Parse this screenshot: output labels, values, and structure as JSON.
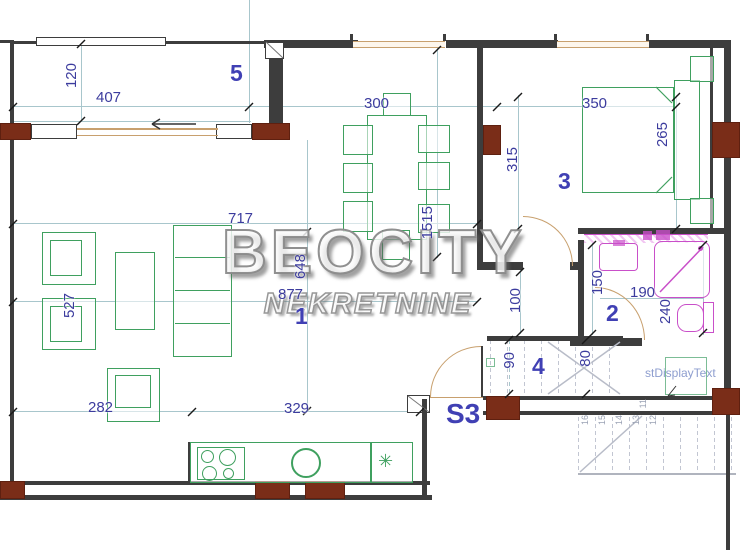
{
  "watermark": {
    "line1": "BEOCITY",
    "line2": "NEKRETNINE"
  },
  "rooms": [
    {
      "id": "5",
      "label": "5",
      "x": 230,
      "y": 62
    },
    {
      "id": "1",
      "label": "1",
      "x": 295,
      "y": 305
    },
    {
      "id": "3",
      "label": "3",
      "x": 558,
      "y": 170
    },
    {
      "id": "2",
      "label": "2",
      "x": 606,
      "y": 302
    },
    {
      "id": "4",
      "label": "4",
      "x": 532,
      "y": 355
    },
    {
      "id": "S3",
      "label": "S3",
      "x": 446,
      "y": 400,
      "big": true
    }
  ],
  "dimensions": [
    {
      "t": "407",
      "x": 96,
      "y": 90
    },
    {
      "t": "120",
      "x": 64,
      "y": 63,
      "v": true
    },
    {
      "t": "300",
      "x": 364,
      "y": 96
    },
    {
      "t": "350",
      "x": 582,
      "y": 96
    },
    {
      "t": "315",
      "x": 505,
      "y": 147,
      "v": true
    },
    {
      "t": "265",
      "x": 655,
      "y": 122,
      "v": true
    },
    {
      "t": "717",
      "x": 228,
      "y": 211
    },
    {
      "t": "1515",
      "x": 420,
      "y": 206,
      "v": true
    },
    {
      "t": "648",
      "x": 293,
      "y": 254,
      "v": true
    },
    {
      "t": "877",
      "x": 278,
      "y": 287
    },
    {
      "t": "527",
      "x": 62,
      "y": 293,
      "v": true
    },
    {
      "t": "282",
      "x": 88,
      "y": 400
    },
    {
      "t": "329",
      "x": 284,
      "y": 401
    },
    {
      "t": "100",
      "x": 508,
      "y": 288,
      "v": true
    },
    {
      "t": "150",
      "x": 590,
      "y": 270,
      "v": true
    },
    {
      "t": "190",
      "x": 630,
      "y": 285
    },
    {
      "t": "240",
      "x": 658,
      "y": 299,
      "v": true
    },
    {
      "t": "90",
      "x": 502,
      "y": 352,
      "v": true
    },
    {
      "t": "80",
      "x": 578,
      "y": 350,
      "v": true
    }
  ],
  "stair_numbers": [
    {
      "t": "16",
      "x": 581,
      "y": 415
    },
    {
      "t": "15",
      "x": 598,
      "y": 415
    },
    {
      "t": "14",
      "x": 615,
      "y": 415
    },
    {
      "t": "13",
      "x": 632,
      "y": 415
    },
    {
      "t": "12",
      "x": 649,
      "y": 415
    },
    {
      "t": "11",
      "x": 639,
      "y": 399
    }
  ],
  "annotations": [
    {
      "t": "stDisplayText",
      "x": 645,
      "y": 366
    }
  ],
  "symbols": {
    "balcony_arrow": "←",
    "kitchen_star": "✳"
  },
  "colors": {
    "wall": "#3d3d3d",
    "brick": "#7a2d18",
    "furniture": "#3fa05f",
    "sanitary": "#c94fc9",
    "door": "#c8a06e",
    "dim_text": "#3c3c9e",
    "room_text": "#4040b4",
    "guide_line": "#a8c6cc",
    "stairs": "#c2c6d2",
    "watermark": "#8f8f8f"
  }
}
